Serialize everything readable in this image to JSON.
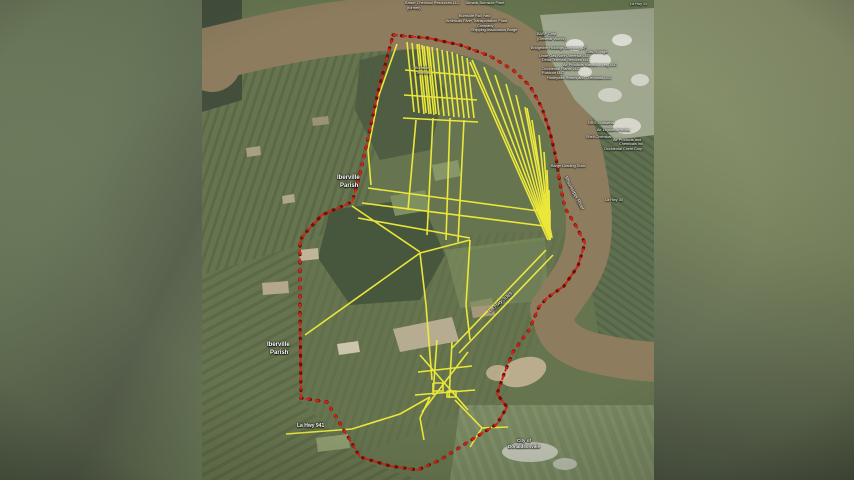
{
  "image_title": "Aerial parcel map with pipeline corridors along the Mississippi River",
  "colors": {
    "boundary_red": "#d42418",
    "boundary_dot_red": "#6e1208",
    "pipeline_yellow": "#f3ee3a",
    "river_brown": "#8d7c5e",
    "field_green": "#66754f",
    "woods_green": "#46553c",
    "industrial_gray": "#a0a78f",
    "sand_tan": "#c3b494",
    "label_white": "#ffffff",
    "backdrop_olive": "#6f7c5d"
  },
  "map": {
    "labels": [
      {
        "name": "label-kaiser-chemical",
        "text": "Kaiser Chemical Resources LLC",
        "x": 405,
        "y": 1,
        "size": 3.8,
        "bold": false,
        "rot": 0
      },
      {
        "name": "label-former",
        "text": "(former)",
        "x": 407,
        "y": 6,
        "size": 3.8,
        "bold": false,
        "rot": 0
      },
      {
        "name": "label-almatis-burnside",
        "text": "Almatis Burnside Plant",
        "x": 466,
        "y": 1,
        "size": 3.8,
        "bold": false,
        "rot": 0
      },
      {
        "name": "label-hwy-44",
        "text": "La Hwy 44",
        "x": 630,
        "y": 2,
        "size": 3.6,
        "bold": false,
        "rot": 0
      },
      {
        "name": "label-burnside-rail",
        "text": "Burnside Rail Yard",
        "x": 459,
        "y": 14,
        "size": 3.8,
        "bold": false,
        "rot": 0
      },
      {
        "name": "label-artco-plant",
        "text": "American River Transportation Plant",
        "x": 446,
        "y": 19,
        "size": 3.8,
        "bold": false,
        "rot": 0
      },
      {
        "name": "label-company",
        "text": "Company",
        "x": 477,
        "y": 24,
        "size": 3.8,
        "bold": false,
        "rot": 0
      },
      {
        "name": "label-shipping-assoc",
        "text": "Shipping Association Barge",
        "x": 471,
        "y": 28,
        "size": 3.8,
        "bold": false,
        "rot": 0
      },
      {
        "name": "label-basf",
        "text": "BASF Corp",
        "x": 537,
        "y": 32,
        "size": 3.8,
        "bold": false,
        "rot": 0
      },
      {
        "name": "label-basf-geismar",
        "text": "(Geismar Works)",
        "x": 537,
        "y": 37,
        "size": 3.8,
        "bold": false,
        "rot": 0
      },
      {
        "name": "label-bridgeline",
        "text": "Bridgeline Holdings Company LP",
        "x": 531,
        "y": 46,
        "size": 3.8,
        "bold": false,
        "rot": 0
      },
      {
        "name": "label-gas-storage",
        "text": "Gas Storage",
        "x": 586,
        "y": 50,
        "size": 3.8,
        "bold": false,
        "rot": 0
      },
      {
        "name": "label-linde",
        "text": "Linde Gas North America LLC",
        "x": 539,
        "y": 54,
        "size": 3.8,
        "bold": false,
        "rot": 0
      },
      {
        "name": "label-delta-terminal",
        "text": "Delta Terminal Services LLC",
        "x": 542,
        "y": 58,
        "size": 3.8,
        "bold": false,
        "rot": 0
      },
      {
        "name": "label-air-products-1",
        "text": "Air Products Manufacturing LLC",
        "x": 563,
        "y": 63,
        "size": 3.8,
        "bold": false,
        "rot": 0
      },
      {
        "name": "label-occidental-plants",
        "text": "Occidental Plants LLC",
        "x": 542,
        "y": 67,
        "size": 3.8,
        "bold": false,
        "rot": 0
      },
      {
        "name": "label-rubicon",
        "text": "Rubicon LLC",
        "x": 542,
        "y": 71,
        "size": 3.8,
        "bold": false,
        "rot": 0
      },
      {
        "name": "label-honeywell",
        "text": "Honeywell Resins and Chemicals LLC",
        "x": 547,
        "y": 76,
        "size": 3.8,
        "bold": false,
        "rot": 0
      },
      {
        "name": "label-burnside-terminal-1",
        "text": "Burnside",
        "x": 415,
        "y": 66,
        "size": 3.6,
        "bold": false,
        "rot": 0
      },
      {
        "name": "label-burnside-terminal-2",
        "text": "Terminal",
        "x": 416,
        "y": 71,
        "size": 3.6,
        "bold": false,
        "rot": 0
      },
      {
        "name": "label-nrg",
        "text": "NRG Louisiana",
        "x": 588,
        "y": 121,
        "size": 3.8,
        "bold": false,
        "rot": 0
      },
      {
        "name": "label-air-liquide",
        "text": "Air Liquide America",
        "x": 597,
        "y": 128,
        "size": 3.8,
        "bold": false,
        "rot": 0
      },
      {
        "name": "label-shell-chemical",
        "text": "Shell Chemical",
        "x": 586,
        "y": 135,
        "size": 3.8,
        "bold": false,
        "rot": 0
      },
      {
        "name": "label-air-products-2",
        "text": "Air Products and",
        "x": 613,
        "y": 138,
        "size": 3.8,
        "bold": false,
        "rot": 0
      },
      {
        "name": "label-chemicals-inc",
        "text": "Chemicals Inc",
        "x": 619,
        "y": 142,
        "size": 3.8,
        "bold": false,
        "rot": 0
      },
      {
        "name": "label-occidental-chem",
        "text": "Occidental Chem Corp",
        "x": 604,
        "y": 147,
        "size": 3.8,
        "bold": false,
        "rot": 0
      },
      {
        "name": "label-barge-loading",
        "text": "Barge Loading Dock",
        "x": 551,
        "y": 164,
        "size": 3.8,
        "bold": false,
        "rot": 0
      },
      {
        "name": "label-mississippi-river",
        "text": "Mississippi River",
        "x": 567,
        "y": 176,
        "size": 5,
        "bold": false,
        "rot": 62
      },
      {
        "name": "label-hwy-30",
        "text": "La Hwy 30",
        "x": 605,
        "y": 198,
        "size": 3.8,
        "bold": false,
        "rot": 0
      },
      {
        "name": "label-iberville-parish-1a",
        "text": "Iberville",
        "x": 337,
        "y": 175,
        "size": 6,
        "bold": true,
        "rot": 0
      },
      {
        "name": "label-iberville-parish-1b",
        "text": "Parish",
        "x": 340,
        "y": 183,
        "size": 6,
        "bold": true,
        "rot": 0
      },
      {
        "name": "label-hwy-3089",
        "text": "La Hwy 3089",
        "x": 488,
        "y": 310,
        "size": 5,
        "bold": false,
        "rot": -39
      },
      {
        "name": "label-iberville-parish-2a",
        "text": "Iberville",
        "x": 267,
        "y": 342,
        "size": 6,
        "bold": true,
        "rot": 0
      },
      {
        "name": "label-iberville-parish-2b",
        "text": "Parish",
        "x": 270,
        "y": 350,
        "size": 6,
        "bold": true,
        "rot": 0
      },
      {
        "name": "label-hwy-941",
        "text": "La Hwy 941",
        "x": 297,
        "y": 424,
        "size": 5,
        "bold": true,
        "rot": 0
      },
      {
        "name": "label-city-of",
        "text": "City of",
        "x": 517,
        "y": 438,
        "size": 4.5,
        "bold": true,
        "rot": 0
      },
      {
        "name": "label-donaldsonville",
        "text": "Donaldsonville",
        "x": 508,
        "y": 444,
        "size": 4.5,
        "bold": true,
        "rot": 0
      }
    ],
    "boundary_points": "393,35 428,38 460,45 490,56 513,70 530,86 542,108 550,132 556,158 560,184 565,208 576,226 585,243 578,266 564,286 547,298 539,307 529,330 513,352 504,374 497,394 507,407 497,424 468,442 440,460 418,470 390,466 360,457 327,402 301,398 300,310 300,240 308,230 322,215 338,208 352,202 358,182 366,148 378,92 393,35",
    "pipeline_segments": [
      [
        407,
        42,
        414,
        112
      ],
      [
        412,
        43,
        419,
        113
      ],
      [
        417,
        44,
        424,
        114
      ],
      [
        422,
        45,
        429,
        114
      ],
      [
        427,
        46,
        434,
        115
      ],
      [
        432,
        47,
        439,
        115
      ],
      [
        437,
        48,
        444,
        116
      ],
      [
        442,
        50,
        449,
        116
      ],
      [
        447,
        51,
        454,
        117
      ],
      [
        452,
        52,
        459,
        117
      ],
      [
        457,
        54,
        464,
        118
      ],
      [
        462,
        56,
        469,
        118
      ],
      [
        467,
        58,
        474,
        118
      ],
      [
        419,
        44,
        426,
        113
      ],
      [
        424,
        46,
        431,
        114
      ],
      [
        429,
        47,
        436,
        114
      ],
      [
        405,
        70,
        476,
        76
      ],
      [
        404,
        95,
        477,
        100
      ],
      [
        403,
        118,
        478,
        122
      ],
      [
        416,
        120,
        408,
        210
      ],
      [
        433,
        118,
        427,
        235
      ],
      [
        450,
        118,
        446,
        240
      ],
      [
        464,
        120,
        458,
        242
      ],
      [
        550,
        240,
        472,
        60
      ],
      [
        550,
        240,
        484,
        67
      ],
      [
        550,
        240,
        495,
        75
      ],
      [
        550,
        240,
        506,
        84
      ],
      [
        550,
        240,
        516,
        95
      ],
      [
        550,
        240,
        525,
        107
      ],
      [
        550,
        240,
        532,
        120
      ],
      [
        550,
        240,
        539,
        135
      ],
      [
        550,
        240,
        544,
        152
      ],
      [
        550,
        240,
        547,
        170
      ],
      [
        550,
        240,
        549,
        190
      ],
      [
        550,
        240,
        550,
        210
      ],
      [
        548,
        240,
        470,
        62
      ],
      [
        552,
        238,
        527,
        108
      ],
      [
        368,
        188,
        546,
        212
      ],
      [
        362,
        203,
        544,
        226
      ],
      [
        352,
        206,
        420,
        252
      ],
      [
        358,
        218,
        470,
        238
      ],
      [
        305,
        335,
        420,
        253
      ],
      [
        420,
        253,
        470,
        240
      ],
      [
        470,
        240,
        466,
        305
      ],
      [
        420,
        253,
        426,
        305
      ],
      [
        426,
        305,
        432,
        380
      ],
      [
        466,
        305,
        470,
        340
      ],
      [
        452,
        348,
        546,
        250
      ],
      [
        459,
        353,
        553,
        255
      ],
      [
        437,
        340,
        433,
        395
      ],
      [
        452,
        342,
        449,
        398
      ],
      [
        418,
        372,
        472,
        366
      ],
      [
        415,
        395,
        475,
        390
      ],
      [
        420,
        355,
        468,
        410
      ],
      [
        468,
        352,
        422,
        412
      ],
      [
        455,
        400,
        482,
        428
      ],
      [
        482,
        428,
        508,
        427
      ],
      [
        482,
        428,
        470,
        447
      ],
      [
        430,
        397,
        420,
        418
      ],
      [
        420,
        418,
        424,
        440
      ]
    ],
    "pipeline_paths": [
      "286,434 352,429 400,414 430,397",
      "397,44 379,95 368,150 371,185",
      "433,383 443,383 443,391 433,391 433,383",
      "447,391 456,391 456,397 447,397 447,391"
    ]
  }
}
